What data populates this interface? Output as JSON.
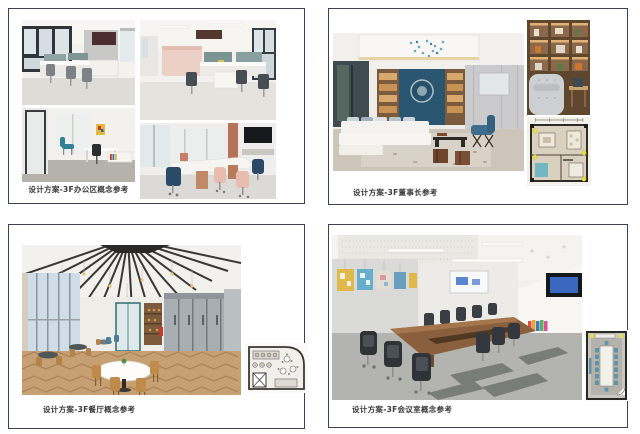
{
  "palette": {
    "panel_border": "#3a4257",
    "caption_color": "#3a3a3c",
    "accent_teal": "#2e8294",
    "accent_navy": "#2c4a68",
    "accent_pink": "#e9bcb0",
    "accent_wood": "#8a6647",
    "accent_blue_chair": "#3f6d8e",
    "plan_marker_yellow": "#e6e23b"
  },
  "panels": [
    {
      "id": "office-area",
      "caption": "设计方案-3F办公区概念参考",
      "photos": [
        "open-office-desks",
        "private-office",
        "open-office-pink-partition",
        "small-meeting-table"
      ]
    },
    {
      "id": "chairman",
      "caption": "设计方案-3F董事长参考",
      "photos": [
        "chairman-lounge",
        "bookshelf-armchair",
        "chairman-floor-plan"
      ]
    },
    {
      "id": "dining",
      "caption": "设计方案-3F餐厅概念参考",
      "photos": [
        "dining-hall",
        "dining-floor-plan"
      ]
    },
    {
      "id": "meeting",
      "caption": "设计方案-3F会议室概念参考",
      "photos": [
        "conference-room",
        "conference-floor-plan"
      ]
    }
  ]
}
